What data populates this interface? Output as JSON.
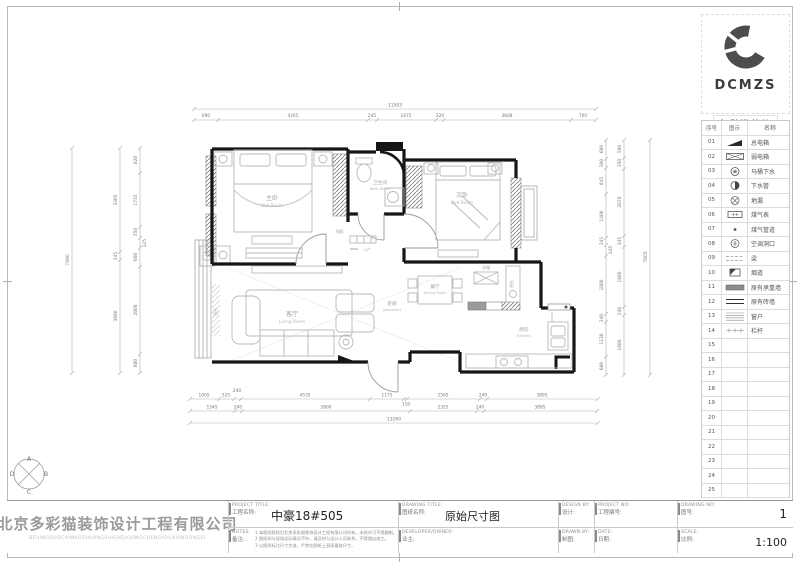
{
  "logo": {
    "brand": "DCMZS",
    "brand_cn": "多彩猫装饰"
  },
  "compass": {
    "top": "A",
    "right": "B",
    "bottom": "C",
    "left": "D"
  },
  "legend": {
    "headers": [
      "序号",
      "图示",
      "名称"
    ],
    "rows": [
      {
        "no": "01",
        "name": "总电箱"
      },
      {
        "no": "02",
        "name": "弱电箱"
      },
      {
        "no": "03",
        "name": "马桶下水"
      },
      {
        "no": "04",
        "name": "下水管"
      },
      {
        "no": "05",
        "name": "地漏"
      },
      {
        "no": "06",
        "name": "煤气表"
      },
      {
        "no": "07",
        "name": "煤气管道"
      },
      {
        "no": "08",
        "name": "空调洞口",
        "glyph": "8"
      },
      {
        "no": "09",
        "name": "梁"
      },
      {
        "no": "10",
        "name": "烟道"
      },
      {
        "no": "11",
        "name": "原有承重墙"
      },
      {
        "no": "12",
        "name": "原有砖墙"
      },
      {
        "no": "13",
        "name": "窗户"
      },
      {
        "no": "14",
        "name": "栏杆"
      },
      {
        "no": "15",
        "name": ""
      },
      {
        "no": "16",
        "name": ""
      },
      {
        "no": "17",
        "name": ""
      },
      {
        "no": "18",
        "name": ""
      },
      {
        "no": "19",
        "name": ""
      },
      {
        "no": "20",
        "name": ""
      },
      {
        "no": "21",
        "name": ""
      },
      {
        "no": "22",
        "name": ""
      },
      {
        "no": "23",
        "name": ""
      },
      {
        "no": "24",
        "name": ""
      },
      {
        "no": "25",
        "name": ""
      }
    ]
  },
  "titlebar": {
    "company": "北京多彩猫装饰设计工程有限公司",
    "company_py": "BEIJINGDUOCAIMAOZHUANGSHISHEJIGONGCHENGYOUXIANGONGSI",
    "project_title_en": "PROJECT TITLE:",
    "project_title_cn": "工程名称:",
    "project_name": "中豪18#505",
    "notes_en": "NOTES:",
    "notes_cn": "备注:",
    "notes": [
      "1  本图纸版权归北京多彩猫装饰设计工程有限公司所有，未经许可不得翻制。",
      "2  图纸如与现场实际情况不符，请及时与设计人员联系，不得擅自施工。",
      "3  以图纸标注尺寸为准，严禁在图纸上直接量取尺寸。"
    ],
    "drawing_title_en": "DRAWING TITLE:",
    "drawing_title_cn": "图纸名称:",
    "drawing_name": "原始尺寸图",
    "owner_en": "DEVELOPER/OWNER:",
    "owner_cn": "业主:",
    "design_en": "DESIGN BY:",
    "design_cn": "设计:",
    "drawn_en": "DRAWN BY:",
    "drawn_cn": "制图:",
    "project_no_en": "PROJECT NO:",
    "project_no_cn": "工程编号:",
    "drawing_no_en": "DRAWING NO:",
    "drawing_no_cn": "图号:",
    "drawing_no": "1",
    "date_en": "DATE:",
    "date_cn": "日期:",
    "scale_en": "SCALE:",
    "scale_cn": "比例:",
    "scale": "1:100"
  },
  "plan": {
    "rooms": {
      "master_cn": "主卧",
      "master_en": "Bed Room",
      "bath_cn": "卫生间",
      "bath_en": "Bath Room",
      "second_cn": "次卧",
      "second_en": "Bed Room",
      "living_cn": "客厅",
      "living_en": "Living Room",
      "dining_cn": "餐厅",
      "dining_en": "Dining Room",
      "kitchen_cn": "厨房",
      "kitchen_en": "Kitchen",
      "corridor_cn": "走廊",
      "corridor_en": "pavement",
      "balcony_cn": "阳台",
      "fridge": "冰箱",
      "bar": "吧台",
      "shoe_cabinet": "鞋柜",
      "entry": "入户"
    },
    "dims": {
      "top_total": "11503",
      "top": [
        "690",
        "4265",
        "245",
        "1675",
        "220",
        "3608",
        "700"
      ],
      "bottom1": [
        "1005",
        "525",
        "240",
        "4535",
        "1175",
        "110",
        "2565",
        "240",
        "3895"
      ],
      "bottom2": [
        "1545",
        "240",
        "5800",
        "2325",
        "240",
        "3895"
      ],
      "bottom_total": "13260",
      "left_inner": [
        "820",
        "1735",
        "350",
        "325",
        "600",
        "2800",
        "600"
      ],
      "left_mid": [
        "3365",
        "245",
        "3880"
      ],
      "left_total": "7490",
      "right_inner": [
        "600",
        "300",
        "845",
        "1400",
        "245",
        "345",
        "1880",
        "240",
        "1130",
        "600"
      ],
      "right_mid": [
        "560",
        "350",
        "2070",
        "345",
        "1880",
        "240",
        "1880"
      ],
      "right_total": "7805"
    }
  }
}
